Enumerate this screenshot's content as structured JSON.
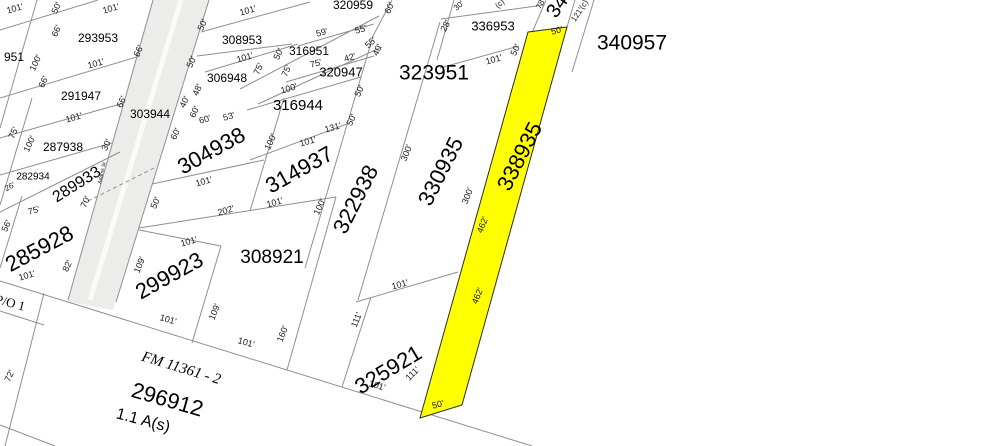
{
  "map": {
    "type": "parcel-plat-map",
    "colors": {
      "background": "#ffffff",
      "parcel_line": "#8f8f8f",
      "highlight_fill": "#ffff00",
      "highlight_stroke": "#2b2b2b",
      "road_fill": "#ececea",
      "road_stripe": "#fafaf8",
      "text": "#000000"
    },
    "highlighted_parcel": {
      "id": "338935",
      "polygon": [
        [
          528,
          32
        ],
        [
          567,
          27
        ],
        [
          462,
          405
        ],
        [
          420,
          418
        ]
      ]
    },
    "road": {
      "name": "Adams St",
      "polygon": [
        [
          153,
          0
        ],
        [
          209,
          0
        ],
        [
          113,
          310
        ],
        [
          68,
          302
        ]
      ],
      "stripe": [
        181,
        0,
        90,
        300
      ],
      "label": {
        "x": 102,
        "y": 173,
        "rot": -77,
        "size": 5
      }
    },
    "parcel_labels": [
      {
        "text": "951",
        "x": 14,
        "y": 58,
        "rot": 0,
        "size": 12
      },
      {
        "text": "293953",
        "x": 98,
        "y": 39,
        "rot": 0,
        "size": 12
      },
      {
        "text": "308953",
        "x": 242,
        "y": 41,
        "rot": 0,
        "size": 12
      },
      {
        "text": "320959",
        "x": 353,
        "y": 6,
        "rot": 0,
        "size": 12
      },
      {
        "text": "316951",
        "x": 309,
        "y": 52,
        "rot": 0,
        "size": 12
      },
      {
        "text": "320947",
        "x": 341,
        "y": 73,
        "rot": 0,
        "size": 13
      },
      {
        "text": "306948",
        "x": 227,
        "y": 79,
        "rot": 0,
        "size": 12
      },
      {
        "text": "316944",
        "x": 298,
        "y": 106,
        "rot": 0,
        "size": 15
      },
      {
        "text": "323951",
        "x": 434,
        "y": 74,
        "rot": 0,
        "size": 21
      },
      {
        "text": "336953",
        "x": 493,
        "y": 27,
        "rot": 0,
        "size": 13
      },
      {
        "text": "340957",
        "x": 632,
        "y": 44,
        "rot": 0,
        "size": 21
      },
      {
        "text": "34",
        "x": 558,
        "y": 7,
        "rot": -55,
        "size": 20
      },
      {
        "text": "303944",
        "x": 150,
        "y": 115,
        "rot": 0,
        "size": 12
      },
      {
        "text": "291947",
        "x": 81,
        "y": 97,
        "rot": 0,
        "size": 12
      },
      {
        "text": "287938",
        "x": 63,
        "y": 148,
        "rot": 0,
        "size": 12
      },
      {
        "text": "282934",
        "x": 33,
        "y": 177,
        "rot": 0,
        "size": 10
      },
      {
        "text": "289933",
        "x": 77,
        "y": 185,
        "rot": -32,
        "size": 16
      },
      {
        "text": "285928",
        "x": 40,
        "y": 250,
        "rot": -28,
        "size": 22
      },
      {
        "text": "304938",
        "x": 212,
        "y": 152,
        "rot": -29,
        "size": 22
      },
      {
        "text": "314937",
        "x": 300,
        "y": 171,
        "rot": -29,
        "size": 22
      },
      {
        "text": "322938",
        "x": 357,
        "y": 200,
        "rot": -63,
        "size": 22
      },
      {
        "text": "330935",
        "x": 442,
        "y": 172,
        "rot": -63,
        "size": 22
      },
      {
        "text": "338935",
        "x": 521,
        "y": 157,
        "rot": -63,
        "size": 22
      },
      {
        "text": "325921",
        "x": 389,
        "y": 371,
        "rot": -31,
        "size": 22
      },
      {
        "text": "299923",
        "x": 170,
        "y": 277,
        "rot": -29,
        "size": 22
      },
      {
        "text": "308921",
        "x": 272,
        "y": 258,
        "rot": 0,
        "size": 19
      },
      {
        "text": "296912",
        "x": 167,
        "y": 401,
        "rot": 16,
        "size": 22
      },
      {
        "text": "FM 11361 - 2",
        "x": 181,
        "y": 369,
        "rot": 17,
        "size": 15,
        "serif": true,
        "italic": true
      },
      {
        "text": "1.1 A(s)",
        "x": 143,
        "y": 421,
        "rot": 15,
        "size": 16
      },
      {
        "text": "P/O 1",
        "x": 10,
        "y": 304,
        "rot": 15,
        "size": 13,
        "serif": true
      }
    ],
    "dimension_labels": [
      {
        "text": "101'",
        "x": 15,
        "y": 9,
        "rot": -16,
        "size": 9
      },
      {
        "text": "50'",
        "x": 57,
        "y": 8,
        "rot": -65,
        "size": 9
      },
      {
        "text": "101'",
        "x": 111,
        "y": 9,
        "rot": -16,
        "size": 9
      },
      {
        "text": "66'",
        "x": 57,
        "y": 31,
        "rot": -65,
        "size": 9
      },
      {
        "text": "66'",
        "x": 139,
        "y": 51,
        "rot": -65,
        "size": 9
      },
      {
        "text": "100'",
        "x": 36,
        "y": 63,
        "rot": -65,
        "size": 9
      },
      {
        "text": "101'",
        "x": 96,
        "y": 64,
        "rot": -16,
        "size": 9
      },
      {
        "text": "66'",
        "x": 44,
        "y": 82,
        "rot": -65,
        "size": 9
      },
      {
        "text": "66'",
        "x": 122,
        "y": 102,
        "rot": -65,
        "size": 9
      },
      {
        "text": "101'",
        "x": 74,
        "y": 118,
        "rot": -16,
        "size": 9
      },
      {
        "text": "75'",
        "x": 14,
        "y": 133,
        "rot": -65,
        "size": 9
      },
      {
        "text": "100'",
        "x": 30,
        "y": 144,
        "rot": -65,
        "size": 9
      },
      {
        "text": "30'",
        "x": 107,
        "y": 145,
        "rot": -65,
        "size": 9
      },
      {
        "text": "26'",
        "x": 10,
        "y": 187,
        "rot": -28,
        "size": 8
      },
      {
        "text": "75'",
        "x": 34,
        "y": 211,
        "rot": -16,
        "size": 9
      },
      {
        "text": "70'",
        "x": 86,
        "y": 202,
        "rot": -65,
        "size": 9
      },
      {
        "text": "56'",
        "x": 7,
        "y": 226,
        "rot": -65,
        "size": 9
      },
      {
        "text": "101'",
        "x": 27,
        "y": 276,
        "rot": -16,
        "size": 9
      },
      {
        "text": "82'",
        "x": 68,
        "y": 266,
        "rot": -65,
        "size": 9
      },
      {
        "text": "72'",
        "x": 10,
        "y": 376,
        "rot": -65,
        "size": 9
      },
      {
        "text": "50'",
        "x": 203,
        "y": 25,
        "rot": -65,
        "size": 9
      },
      {
        "text": "101'",
        "x": 248,
        "y": 11,
        "rot": -16,
        "size": 9
      },
      {
        "text": "101'",
        "x": 245,
        "y": 58,
        "rot": -16,
        "size": 9
      },
      {
        "text": "50'",
        "x": 192,
        "y": 62,
        "rot": -65,
        "size": 9
      },
      {
        "text": "50'",
        "x": 279,
        "y": 54,
        "rot": -65,
        "size": 9
      },
      {
        "text": "60'",
        "x": 390,
        "y": 8,
        "rot": -65,
        "size": 9
      },
      {
        "text": "59'",
        "x": 322,
        "y": 33,
        "rot": -16,
        "size": 9
      },
      {
        "text": "55'",
        "x": 361,
        "y": 30,
        "rot": -16,
        "size": 9
      },
      {
        "text": "55'",
        "x": 371,
        "y": 43,
        "rot": -42,
        "size": 9
      },
      {
        "text": "40'",
        "x": 378,
        "y": 50,
        "rot": -65,
        "size": 9
      },
      {
        "text": "42'",
        "x": 350,
        "y": 58,
        "rot": -16,
        "size": 9
      },
      {
        "text": "75'",
        "x": 259,
        "y": 69,
        "rot": -65,
        "size": 9
      },
      {
        "text": "75'",
        "x": 287,
        "y": 71,
        "rot": -65,
        "size": 9
      },
      {
        "text": "75'",
        "x": 316,
        "y": 64,
        "rot": -16,
        "size": 9
      },
      {
        "text": "100'",
        "x": 289,
        "y": 89,
        "rot": -16,
        "size": 9
      },
      {
        "text": "50'",
        "x": 360,
        "y": 91,
        "rot": -65,
        "size": 9
      },
      {
        "text": "48'",
        "x": 198,
        "y": 90,
        "rot": -65,
        "size": 9
      },
      {
        "text": "40'",
        "x": 185,
        "y": 102,
        "rot": -65,
        "size": 9
      },
      {
        "text": "60'",
        "x": 195,
        "y": 112,
        "rot": -65,
        "size": 9
      },
      {
        "text": "53'",
        "x": 229,
        "y": 117,
        "rot": -16,
        "size": 9
      },
      {
        "text": "60'",
        "x": 205,
        "y": 120,
        "rot": -16,
        "size": 9
      },
      {
        "text": "60'",
        "x": 176,
        "y": 134,
        "rot": -65,
        "size": 9
      },
      {
        "text": "131'",
        "x": 333,
        "y": 128,
        "rot": -16,
        "size": 9
      },
      {
        "text": "50'",
        "x": 352,
        "y": 120,
        "rot": -65,
        "size": 9
      },
      {
        "text": "100'",
        "x": 271,
        "y": 142,
        "rot": -65,
        "size": 9
      },
      {
        "text": "101'",
        "x": 308,
        "y": 142,
        "rot": -16,
        "size": 9
      },
      {
        "text": "101'",
        "x": 204,
        "y": 182,
        "rot": -16,
        "size": 9
      },
      {
        "text": "202'",
        "x": 226,
        "y": 211,
        "rot": -16,
        "size": 9
      },
      {
        "text": "101'",
        "x": 275,
        "y": 203,
        "rot": -16,
        "size": 9
      },
      {
        "text": "100'",
        "x": 320,
        "y": 207,
        "rot": -65,
        "size": 9
      },
      {
        "text": "50'",
        "x": 156,
        "y": 203,
        "rot": -65,
        "size": 9
      },
      {
        "text": "300'",
        "x": 407,
        "y": 153,
        "rot": -68,
        "size": 9
      },
      {
        "text": "300'",
        "x": 468,
        "y": 196,
        "rot": -68,
        "size": 9
      },
      {
        "text": "462'",
        "x": 483,
        "y": 225,
        "rot": -68,
        "size": 9
      },
      {
        "text": "462'",
        "x": 478,
        "y": 296,
        "rot": -68,
        "size": 9
      },
      {
        "text": "101'",
        "x": 400,
        "y": 285,
        "rot": -16,
        "size": 9
      },
      {
        "text": "111'",
        "x": 357,
        "y": 320,
        "rot": -68,
        "size": 9
      },
      {
        "text": "109'",
        "x": 140,
        "y": 265,
        "rot": -68,
        "size": 9
      },
      {
        "text": "101'",
        "x": 189,
        "y": 242,
        "rot": -16,
        "size": 9
      },
      {
        "text": "109'",
        "x": 215,
        "y": 312,
        "rot": -68,
        "size": 9
      },
      {
        "text": "160'",
        "x": 283,
        "y": 334,
        "rot": -68,
        "size": 9
      },
      {
        "text": "101'",
        "x": 168,
        "y": 320,
        "rot": 16,
        "size": 9
      },
      {
        "text": "101'",
        "x": 246,
        "y": 343,
        "rot": 16,
        "size": 9
      },
      {
        "text": "101'",
        "x": 377,
        "y": 386,
        "rot": 16,
        "size": 9
      },
      {
        "text": "111'",
        "x": 413,
        "y": 374,
        "rot": -45,
        "size": 9
      },
      {
        "text": "50'",
        "x": 438,
        "y": 405,
        "rot": -14,
        "size": 9
      },
      {
        "text": "50'",
        "x": 557,
        "y": 31,
        "rot": -14,
        "size": 9
      },
      {
        "text": "101'",
        "x": 494,
        "y": 60,
        "rot": -16,
        "size": 9
      },
      {
        "text": "50'",
        "x": 516,
        "y": 50,
        "rot": -65,
        "size": 9
      },
      {
        "text": "28'",
        "x": 446,
        "y": 26,
        "rot": -62,
        "size": 9
      },
      {
        "text": "30'",
        "x": 459,
        "y": 6,
        "rot": -42,
        "size": 8
      },
      {
        "text": "(c)",
        "x": 500,
        "y": 4,
        "rot": -42,
        "size": 8
      },
      {
        "text": "78'",
        "x": 541,
        "y": 4,
        "rot": -62,
        "size": 8
      },
      {
        "text": "121'(c)",
        "x": 580,
        "y": 11,
        "rot": -57,
        "size": 8
      }
    ],
    "lines": {
      "solid": [
        [
          37,
          0,
          0,
          128
        ],
        [
          153,
          0,
          68,
          300
        ],
        [
          209,
          0,
          116,
          302
        ],
        [
          32,
          98,
          0,
          205
        ],
        [
          22,
          196,
          0,
          268
        ],
        [
          221,
          246,
          192,
          343
        ],
        [
          336,
          197,
          287,
          370
        ],
        [
          284,
          98,
          250,
          211
        ],
        [
          373,
          36,
          305,
          268
        ],
        [
          440,
          22,
          358,
          300
        ],
        [
          371,
          297,
          342,
          387
        ],
        [
          44,
          293,
          5,
          446
        ],
        [
          575,
          0,
          567,
          27
        ],
        [
          594,
          0,
          572,
          72
        ],
        [
          454,
          0,
          437,
          60
        ],
        [
          546,
          0,
          529,
          40
        ],
        [
          392,
          0,
          373,
          36
        ],
        [
          0,
          30,
          98,
          0
        ],
        [
          0,
          98,
          140,
          56
        ],
        [
          0,
          138,
          124,
          103
        ],
        [
          0,
          175,
          112,
          143
        ],
        [
          0,
          212,
          120,
          152
        ],
        [
          152,
          184,
          264,
          160
        ],
        [
          139,
          228,
          336,
          197
        ],
        [
          250,
          160,
          347,
          124
        ],
        [
          247,
          110,
          361,
          77
        ],
        [
          205,
          72,
          298,
          44
        ],
        [
          201,
          32,
          310,
          2
        ],
        [
          197,
          56,
          292,
          44
        ],
        [
          298,
          46,
          374,
          24
        ],
        [
          286,
          82,
          374,
          56
        ],
        [
          240,
          89,
          379,
          16
        ],
        [
          258,
          104,
          382,
          47
        ],
        [
          440,
          68,
          519,
          46
        ],
        [
          441,
          19,
          544,
          5
        ],
        [
          356,
          302,
          458,
          272
        ],
        [
          0,
          281,
          532,
          446
        ],
        [
          0,
          311,
          44,
          325
        ],
        [
          0,
          425,
          55,
          446
        ],
        [
          139,
          230,
          221,
          246
        ]
      ],
      "dashed": [
        [
          88,
          201,
          156,
          167
        ]
      ]
    }
  }
}
